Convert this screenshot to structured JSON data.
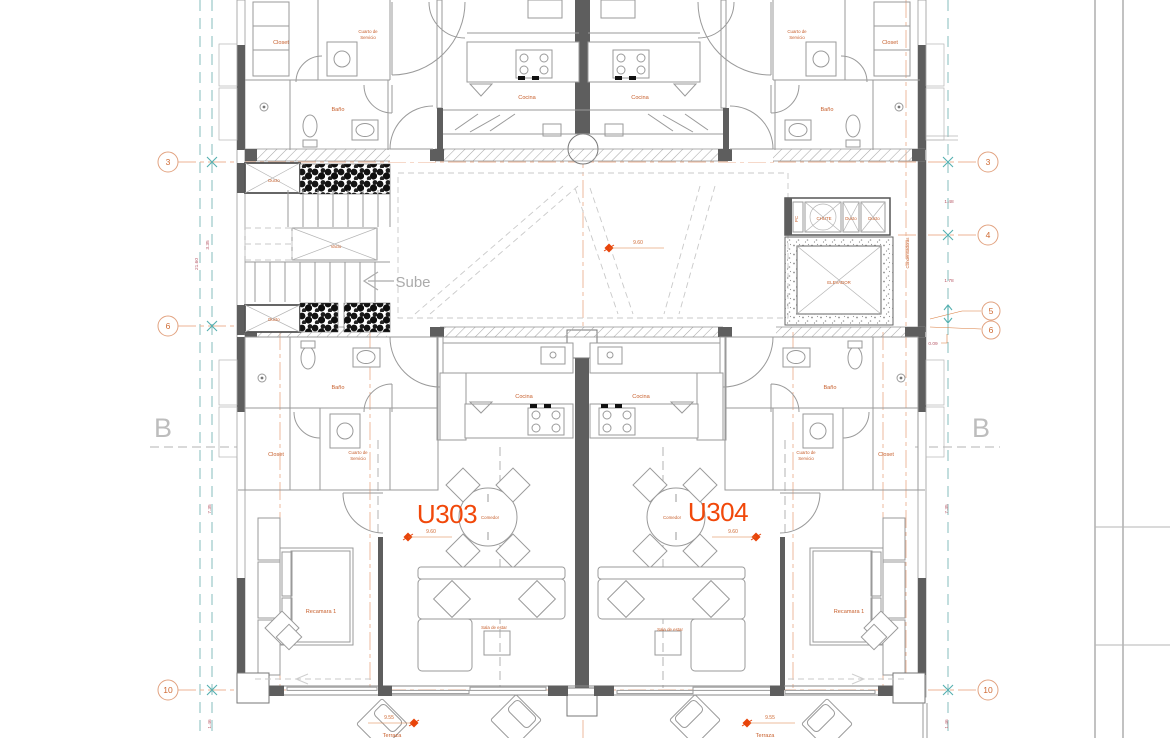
{
  "title": "Residential floor plan - level 3",
  "t": {
    "closet": "Closet",
    "service1": "Cuarto de",
    "service2": "Servicio",
    "bath": "Baño",
    "kitchen": "Cocina",
    "dining": "Comedor",
    "living": "Sala de estar",
    "bedroom": "Recamara 1",
    "terrace": "Terraza",
    "duct": "Ducto",
    "vacio": "Vacio",
    "up": "Sube",
    "elevator": "ELEVADOR",
    "chute": "CHUTE",
    "pc": "PC",
    "condensers": "Condensadoras",
    "unit_left": "U303",
    "unit_right": "U304"
  },
  "grid": {
    "g3": "3",
    "g4": "4",
    "g5": "5",
    "g6": "6",
    "g10": "10",
    "gB": "B"
  },
  "dims": {
    "d335": "3.35",
    "d2160": "21.60",
    "d735": "7.35",
    "d146": "1.46",
    "d148": "1.48",
    "d178": "1.78",
    "d009": "0.09",
    "d955": "9.55",
    "d960": "9.60"
  },
  "colors": {
    "room_label_orange": "#c75f2c",
    "unit_label_orange": "#f1480a",
    "grid_salmon": "#e2a381",
    "axis_teal": "#55b0b0",
    "dimension_red": "#b85a68",
    "wall_gray": "#5e5e5e"
  }
}
